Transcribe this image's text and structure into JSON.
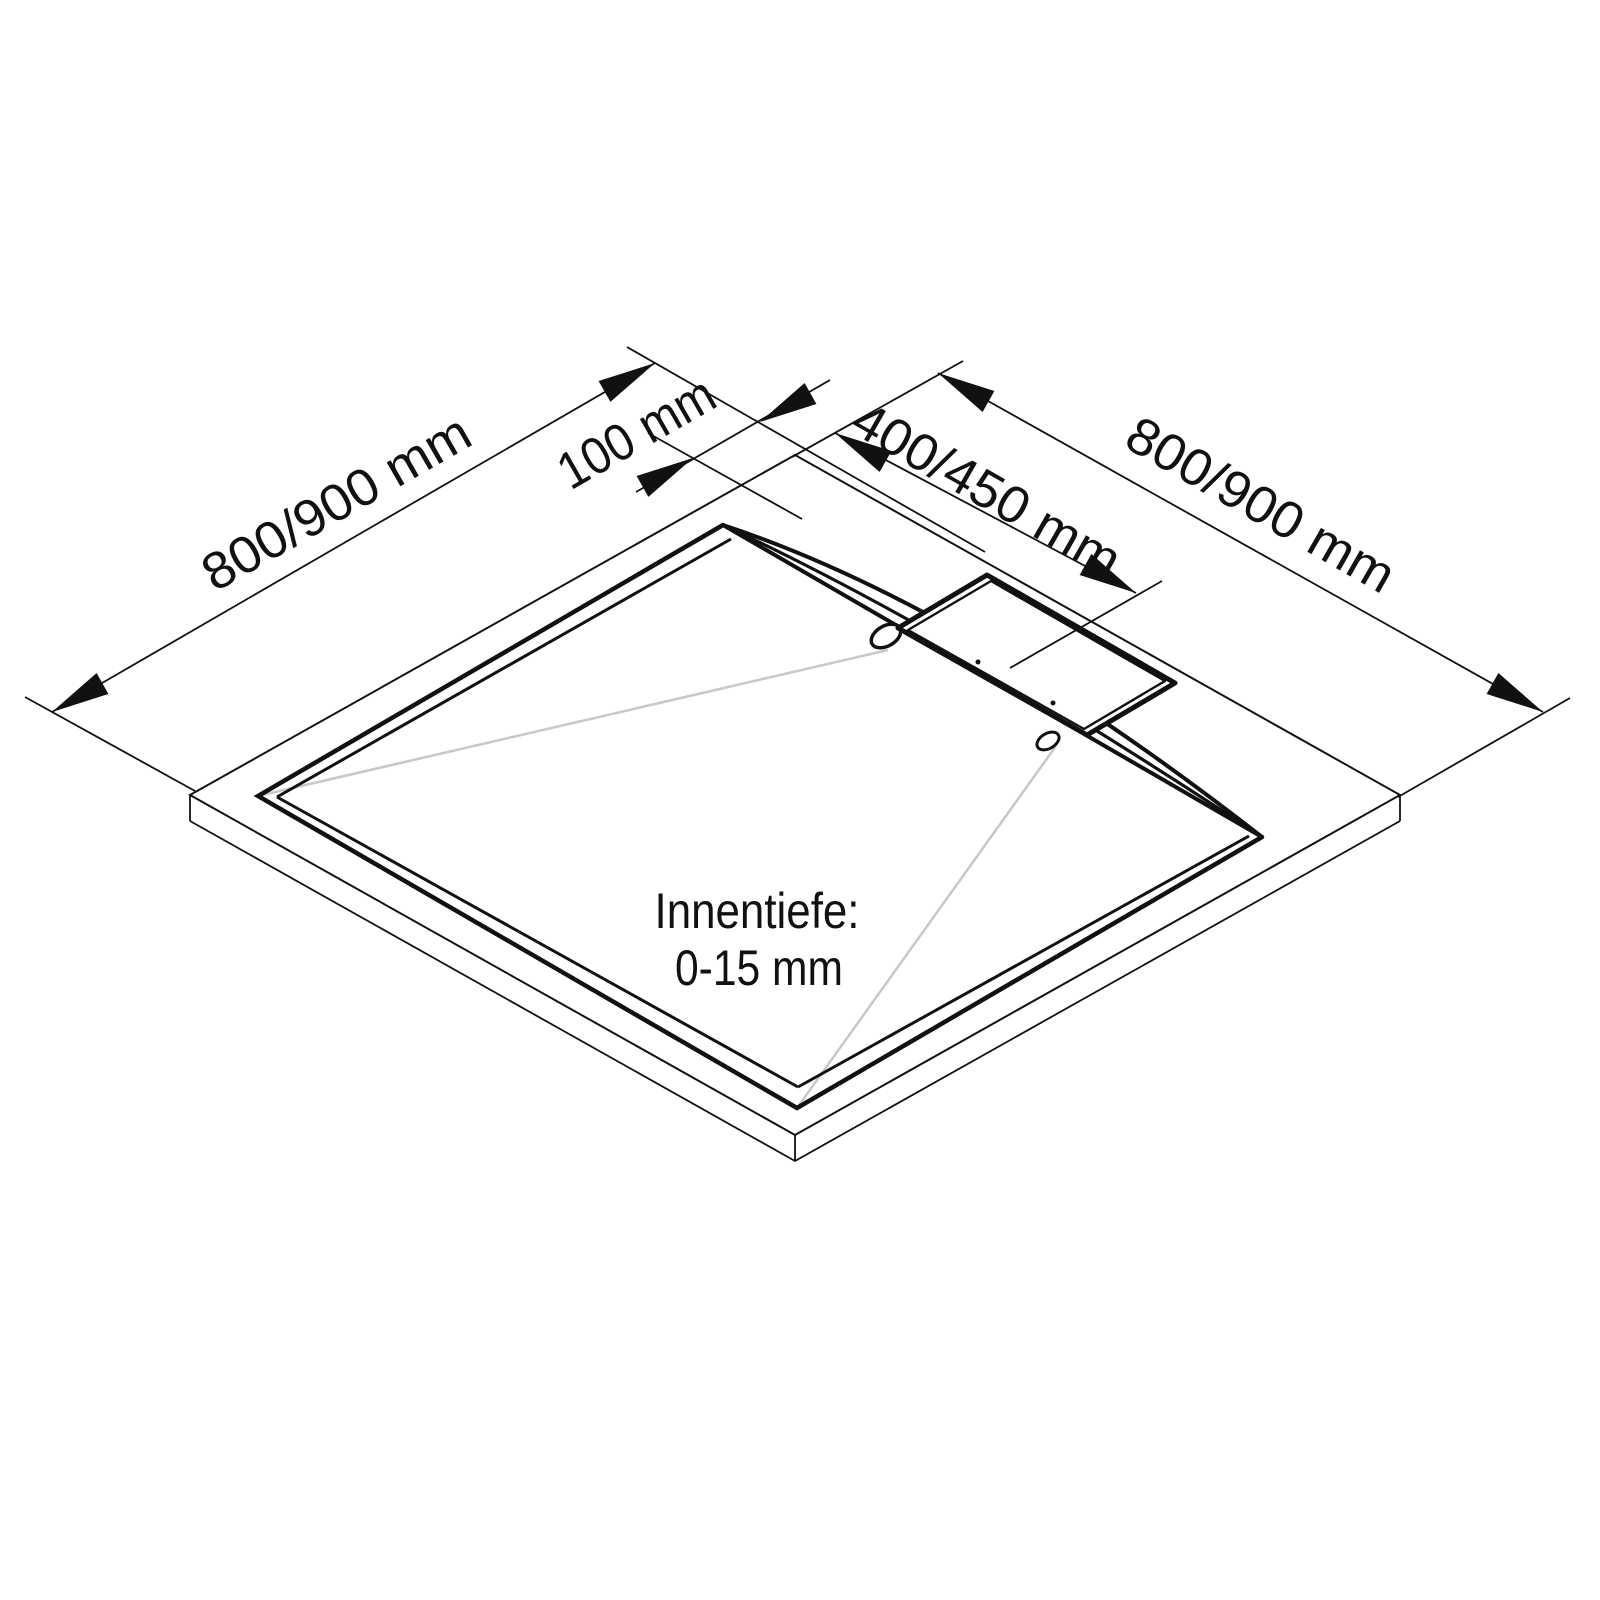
{
  "drawing": {
    "kind": "isometric technical drawing",
    "subject": "square shower tray with linear drain cover"
  },
  "colors": {
    "line": "#111111",
    "slope_guide": "#c9c9c9",
    "background": "#ffffff"
  },
  "dimensions": {
    "top_left_edge": {
      "label": "800/900 mm"
    },
    "rim_inset": {
      "label": "100 mm"
    },
    "drain_offset": {
      "label": "400/450 mm"
    },
    "top_right_edge": {
      "label": "800/900 mm"
    }
  },
  "annotation": {
    "line1": "Innentiefe:",
    "line2": "0-15 mm"
  }
}
